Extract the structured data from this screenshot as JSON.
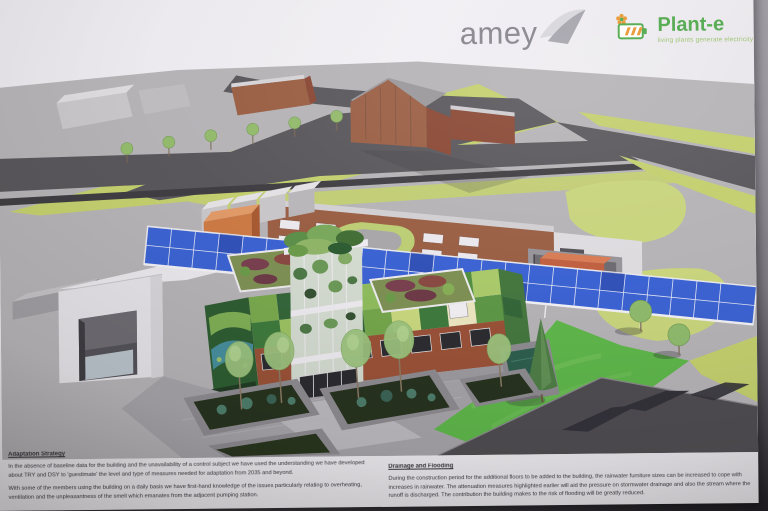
{
  "photo": {
    "background_top": "#a3a0a8",
    "background_bottom": "#232127"
  },
  "poster": {
    "background": "#f1eff3"
  },
  "header": {
    "amey_logo": {
      "text": "amey"
    },
    "plante_logo": {
      "text": "Plant-e",
      "tagline": "living plants generate electricity"
    }
  },
  "rendering": {
    "type": "aerial-3d-architectural-rendering",
    "palette": {
      "ground": "#b6b3b7",
      "road": "#5a575c",
      "road_dark": "#403e42",
      "grass_light": "#c3cf6e",
      "grass_bright": "#5fb64b",
      "solar_blue": "#3c63d2",
      "brick": "#9a5f44",
      "brick_dark": "#8a4834",
      "living_wall_dark": "#2f5d33",
      "living_wall_mid": "#5f9c45",
      "sedum_red": "#7a4050",
      "container_orange": "#cc7a45",
      "pond": "#2e5e4e",
      "white_building": "#e9e7eb"
    }
  },
  "sections": {
    "adaptation": {
      "heading": "Adaptation Strategy",
      "paragraphs": [
        "In the absence of baseline data for the building and the unavailability of a control subject we have used the understanding we have developed about TRY and DSY to 'guestimate' the level and type of measures needed for adaptation from 2035 and beyond.",
        "With some of the members using the building on a daily basis we have first-hand knowledge of the issues particularly relating to overheating, ventilation and the unpleasantness of the smell which emanates from the adjacent pumping station."
      ]
    },
    "drainage": {
      "heading": "Drainage and Flooding",
      "paragraphs": [
        "During the construction period for the additional floors to be added to the building, the rainwater furniture sizes can be increased to cope with increases in rainwater. The attenuation measures highlighted earlier will aid the pressure on stormwater drainage and also the stream where the runoff is discharged. The contribution the building makes to the risk of flooding will be greatly reduced."
      ]
    }
  }
}
